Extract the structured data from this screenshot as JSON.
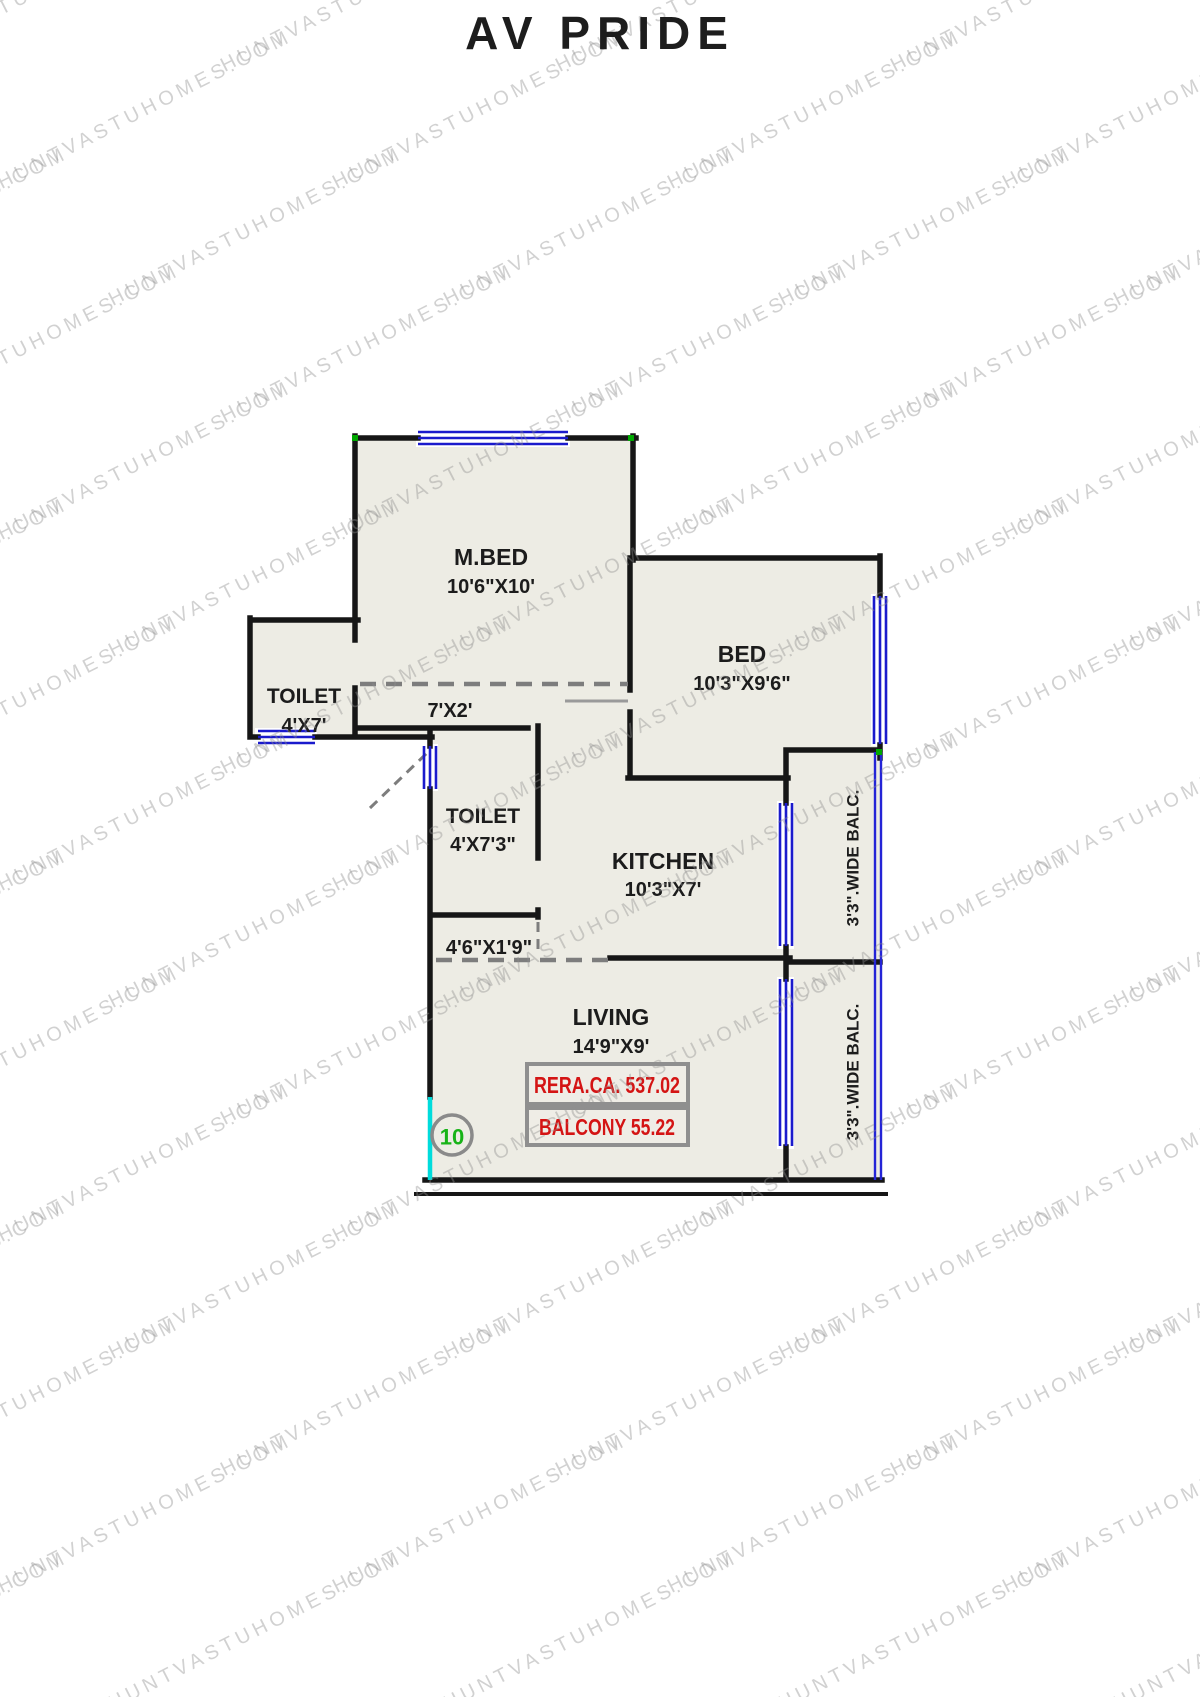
{
  "title": "AV PRIDE",
  "watermark": {
    "text": "HUNTVASTUHOMES.COM"
  },
  "colors": {
    "wall": "#161616",
    "floor": "#edece4",
    "window": "#1a1acc",
    "railing": "#2424d6",
    "entry": "#00dcdc",
    "dashed": "#7d7d7d",
    "door_leaf": "#9a9a9a",
    "info_text": "#d41414",
    "info_border": "#8f8f8f",
    "unit_number": "#17b317",
    "corner_marker": "#00a800",
    "label": "#1c1c1c"
  },
  "plan": {
    "rooms": [
      {
        "name": "M.BED",
        "dims": "10'6\"X10'"
      },
      {
        "name": "BED",
        "dims": "10'3\"X9'6\""
      },
      {
        "name": "TOILET",
        "dims": "4'X7'"
      },
      {
        "name": "TOILET",
        "dims": "4'X7'3\""
      },
      {
        "name": "KITCHEN",
        "dims": "10'3\"X7'"
      },
      {
        "name": "LIVING",
        "dims": "14'9\"X9'"
      }
    ],
    "passages": [
      {
        "dims": "7'X2'"
      },
      {
        "dims": "4'6\"X1'9\""
      }
    ],
    "balconies": [
      {
        "label": "3'3\".WIDE BALC."
      },
      {
        "label": "3'3\".WIDE BALC."
      }
    ],
    "info_boxes": [
      {
        "text": "RERA.CA. 537.02"
      },
      {
        "text": "BALCONY 55.22"
      }
    ],
    "unit_number": "10"
  }
}
